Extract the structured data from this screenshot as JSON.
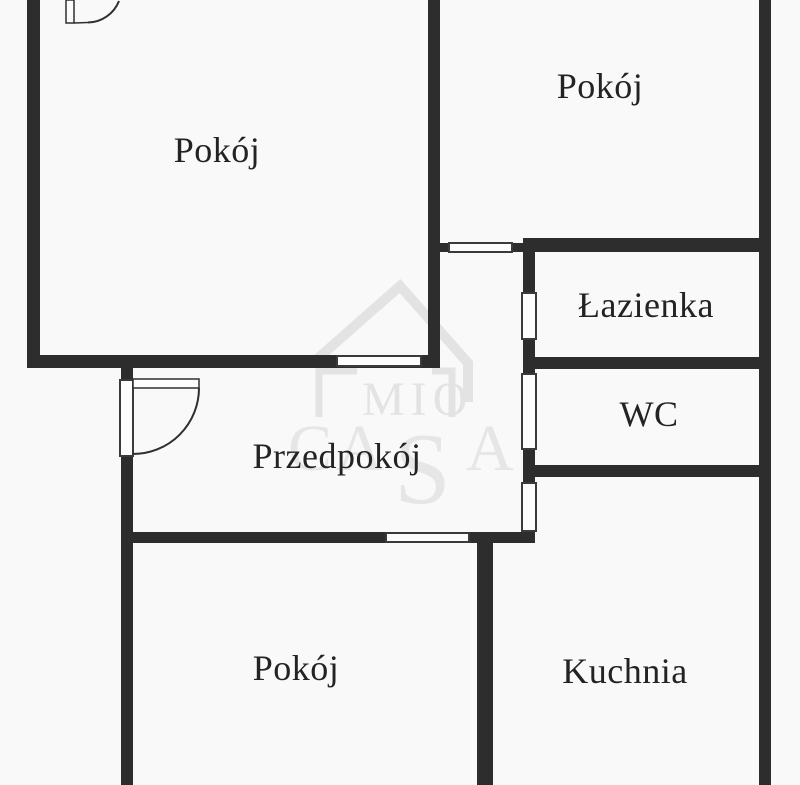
{
  "watermark": {
    "brand_top": "MIO",
    "brand_c": "C",
    "brand_a1": "A",
    "brand_s": "S",
    "brand_a2": "A"
  },
  "rooms": {
    "room_top_left": {
      "label": "Pokój"
    },
    "room_top_right": {
      "label": "Pokój"
    },
    "bathroom": {
      "label": "Łazienka"
    },
    "wc": {
      "label": "WC"
    },
    "hall": {
      "label": "Przedpokój"
    },
    "room_bottom": {
      "label": "Pokój"
    },
    "kitchen": {
      "label": "Kuchnia"
    }
  },
  "colors": {
    "wall": "#2d2d2d",
    "background": "#f9f9f9",
    "watermark": "#e3e3e3",
    "label": "#232323"
  }
}
